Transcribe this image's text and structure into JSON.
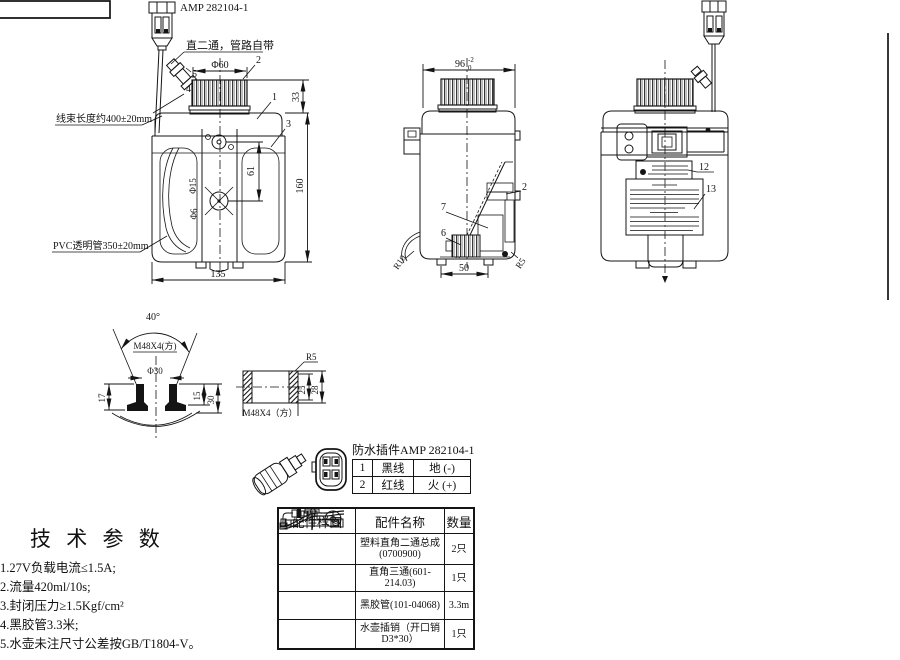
{
  "front_view": {
    "connector_label": "AMP 282104-1",
    "note": "直二通，管路自带",
    "harness_label": "线束长度约400±20mm",
    "pvc_label": "PVC透明管350±20mm",
    "dims": {
      "cap_dia": "Φ60",
      "cap_h": "33",
      "body_h": "160",
      "body_w": "135",
      "plate": "61",
      "d15": "Φ15",
      "d6": "Φ6"
    },
    "callouts": {
      "c1": "1",
      "c2": "2",
      "c3": "3",
      "c4": "4",
      "c5": "5"
    }
  },
  "side_view": {
    "dims": {
      "width": "96",
      "tol_up": "-2",
      "tol_dn": "0",
      "bottom": "50"
    },
    "radii": {
      "left": "R10",
      "right": "R5"
    },
    "callouts": {
      "c2": "2",
      "c6": "6",
      "c7": "7"
    }
  },
  "rear_view": {
    "callouts": {
      "c12": "12",
      "c13": "13"
    }
  },
  "neck_detail": {
    "angle": "40°",
    "thread": "M48X4(方)",
    "dia": "Φ30",
    "dims": {
      "d17": "17",
      "d15": "15",
      "d30": "30"
    }
  },
  "cap_detail": {
    "radius": "R5",
    "dims": {
      "d25": "25",
      "d28": "28"
    },
    "thread": "M48X4（方）"
  },
  "connector_table": {
    "title": "防水插件AMP 282104-1",
    "rows": [
      {
        "no": "1",
        "wire": "黑线",
        "role": "地 (-)"
      },
      {
        "no": "2",
        "wire": "红线",
        "role": "火 (+)"
      }
    ]
  },
  "parts_table": {
    "headers": [
      "配件样图",
      "配件名称",
      "数量"
    ],
    "rows": [
      {
        "name": "塑料直角二通总成\n(0700900)",
        "qty": "2只"
      },
      {
        "name": "直角三通(601-214.03)",
        "qty": "1只"
      },
      {
        "name": "黑胶管(101-04068)",
        "qty": "3.3m"
      },
      {
        "name": "水壶插销（开口销\nD3*30）",
        "qty": "1只"
      }
    ]
  },
  "tech_params": {
    "title": "技 术 参 数",
    "items": [
      "1.27V负载电流≤1.5A;",
      "2.流量420ml/10s;",
      "3.封闭压力≥1.5Kgf/cm²",
      "4.黑胶管3.3米;",
      "5.水壶未注尺寸公差按GB/T1804-V。"
    ]
  }
}
